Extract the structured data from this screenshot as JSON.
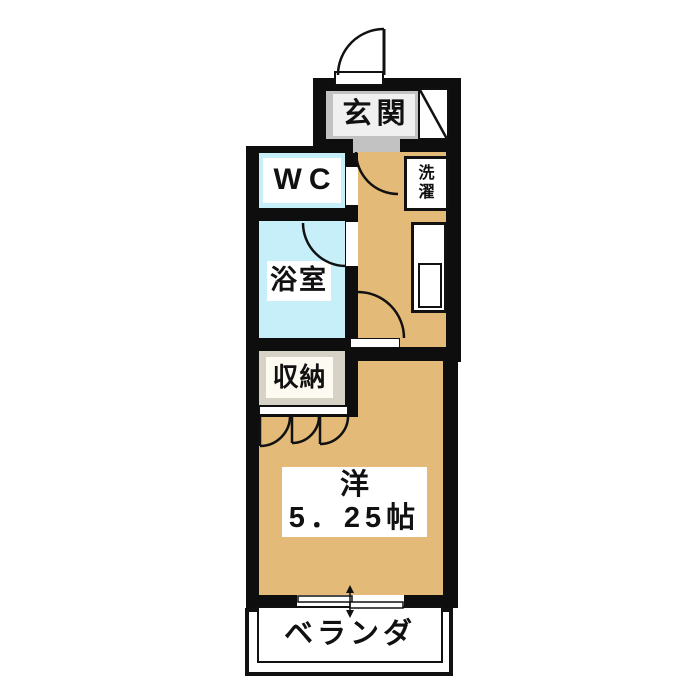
{
  "rooms": {
    "genkan": {
      "label": "玄関"
    },
    "wc": {
      "label": "WC"
    },
    "bathroom": {
      "label": "浴室"
    },
    "closet": {
      "label": "収納"
    },
    "laundry": {
      "line1": "洗",
      "line2": "濯"
    },
    "main_room": {
      "line1": "洋",
      "line2": "5．25帖"
    },
    "veranda": {
      "label": "ベランダ"
    }
  },
  "colors": {
    "wall": "#0e0e0e",
    "wood_floor": "#e3ba78",
    "wet_area": "#c6effa",
    "entrance_floor": "#c2c2c2",
    "entrance_label_bg": "#f0f0f0",
    "closet_floor": "#d6d2c6",
    "closet_label_bg": "#fdfaf1",
    "label_bg": "#ffffff"
  }
}
